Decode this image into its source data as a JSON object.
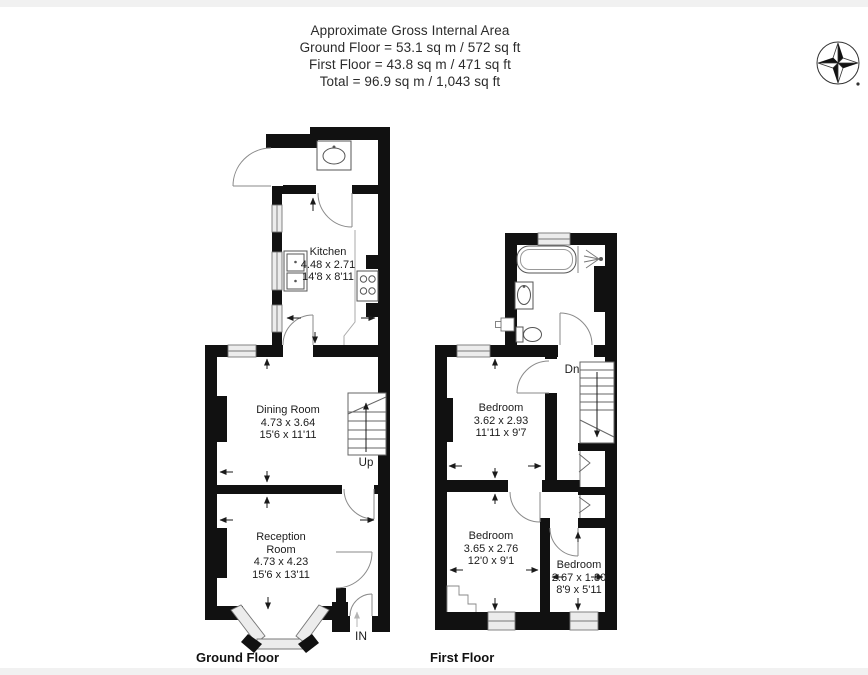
{
  "header": {
    "title": "Approximate Gross Internal Area",
    "ground_line": "Ground Floor = 53.1 sq m / 572 sq ft",
    "first_line": "First Floor = 43.8 sq m / 471 sq ft",
    "total_line": "Total = 96.9 sq m / 1,043 sq ft"
  },
  "compass": {
    "icon": "compass-north-icon"
  },
  "ground_floor": {
    "label": "Ground Floor",
    "stairs_label": "Up",
    "entrance_label": "IN",
    "rooms": {
      "kitchen": {
        "name": "Kitchen",
        "metric": "4.48 x 2.71",
        "imperial": "14'8 x 8'11"
      },
      "dining": {
        "name": "Dining Room",
        "metric": "4.73 x 3.64",
        "imperial": "15'6 x 11'11"
      },
      "reception": {
        "name": "Reception Room",
        "metric": "4.73 x 4.23",
        "imperial": "15'6 x 13'11"
      }
    }
  },
  "first_floor": {
    "label": "First Floor",
    "stairs_label": "Dn",
    "rooms": {
      "bedroom1": {
        "name": "Bedroom",
        "metric": "3.62 x 2.93",
        "imperial": "11'11 x 9'7"
      },
      "bedroom2": {
        "name": "Bedroom",
        "metric": "3.65 x 2.76",
        "imperial": "12'0 x 9'1"
      },
      "bedroom3": {
        "name": "Bedroom",
        "metric": "2.67 x 1.80",
        "imperial": "8'9 x 5'11"
      }
    }
  },
  "colors": {
    "wall": "#111111",
    "thin_line": "#888888",
    "glazing": "#ececec",
    "text": "#1c1c1c"
  }
}
